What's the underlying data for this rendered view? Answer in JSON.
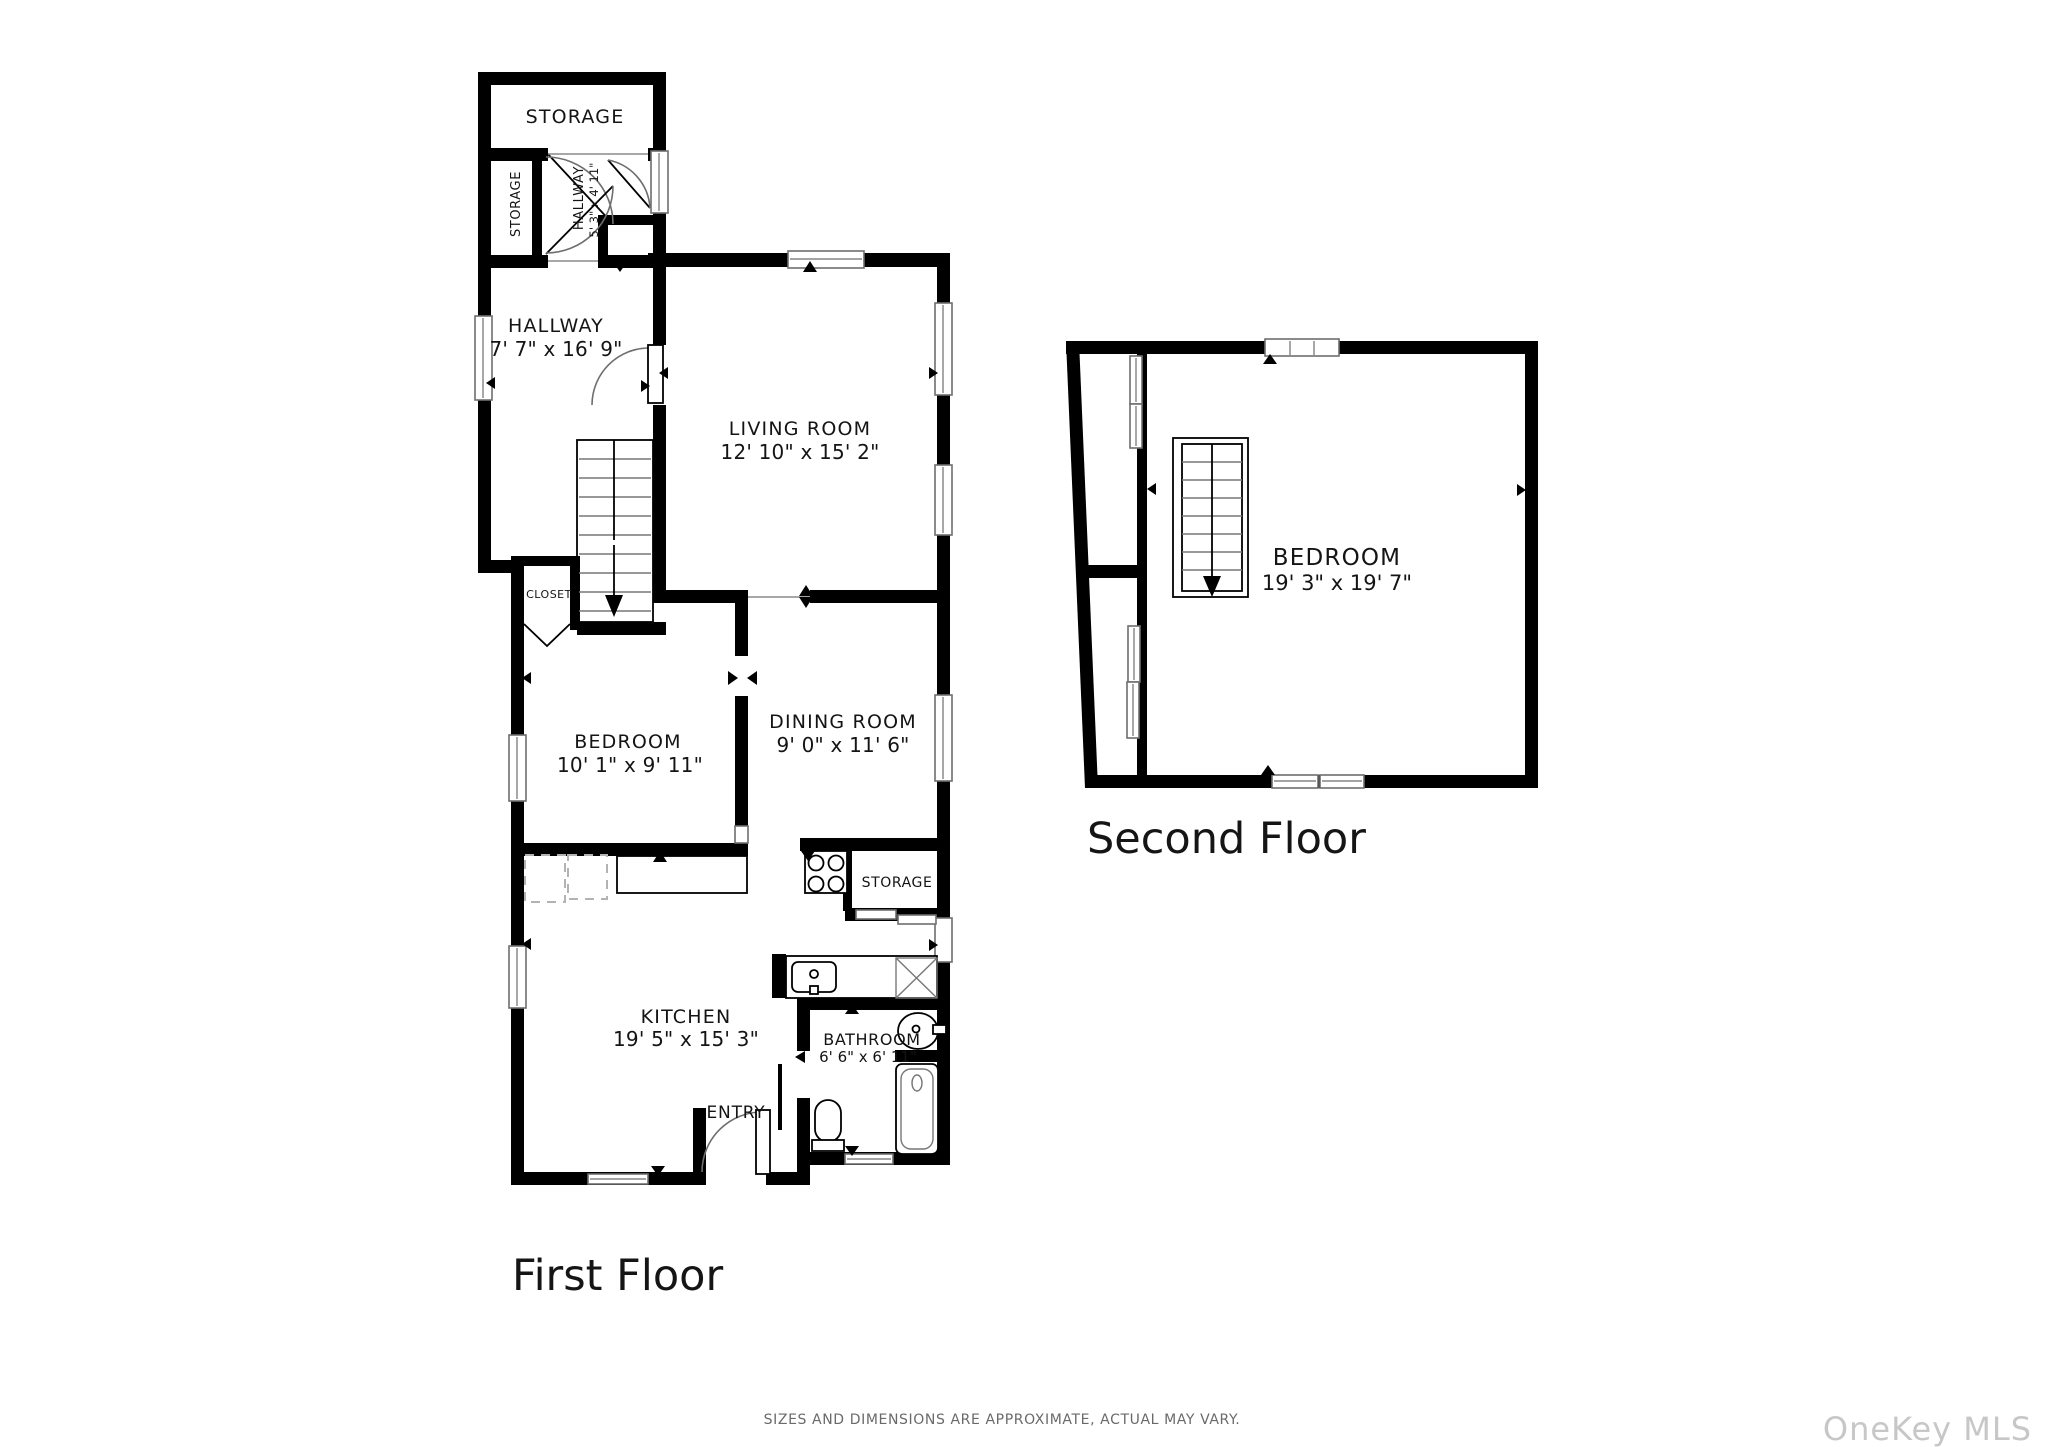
{
  "colors": {
    "wall": "#000000",
    "background": "#ffffff",
    "disclaimer_text": "#6a6a6a",
    "watermark_text": "#c7c7c7"
  },
  "first_floor": {
    "title": "First Floor",
    "storage_top": {
      "label": "STORAGE"
    },
    "storage_closet": {
      "label": "STORAGE"
    },
    "upper_hallway": {
      "label": "HALLWAY",
      "dims": "5' 3\" x 4' 11\""
    },
    "hallway": {
      "label": "HALLWAY",
      "dims": "7' 7\" x 16' 9\""
    },
    "living_room": {
      "label": "LIVING ROOM",
      "dims": "12' 10\" x 15' 2\""
    },
    "closet": {
      "label": "CLOSET"
    },
    "bedroom": {
      "label": "BEDROOM",
      "dims": "10' 1\" x 9' 11\""
    },
    "dining_room": {
      "label": "DINING ROOM",
      "dims": "9' 0\" x 11' 6\""
    },
    "kitchen_storage": {
      "label": "STORAGE"
    },
    "kitchen": {
      "label": "KITCHEN",
      "dims": "19' 5\" x 15' 3\""
    },
    "bathroom": {
      "label": "BATHROOM",
      "dims": "6' 6\" x 6' 11\""
    },
    "entry": {
      "label": "ENTRY"
    }
  },
  "second_floor": {
    "title": "Second Floor",
    "bedroom": {
      "label": "BEDROOM",
      "dims": "19' 3\" x 19' 7\""
    }
  },
  "footer": {
    "disclaimer": "SIZES AND DIMENSIONS ARE APPROXIMATE, ACTUAL MAY VARY.",
    "watermark": "OneKey MLS"
  }
}
